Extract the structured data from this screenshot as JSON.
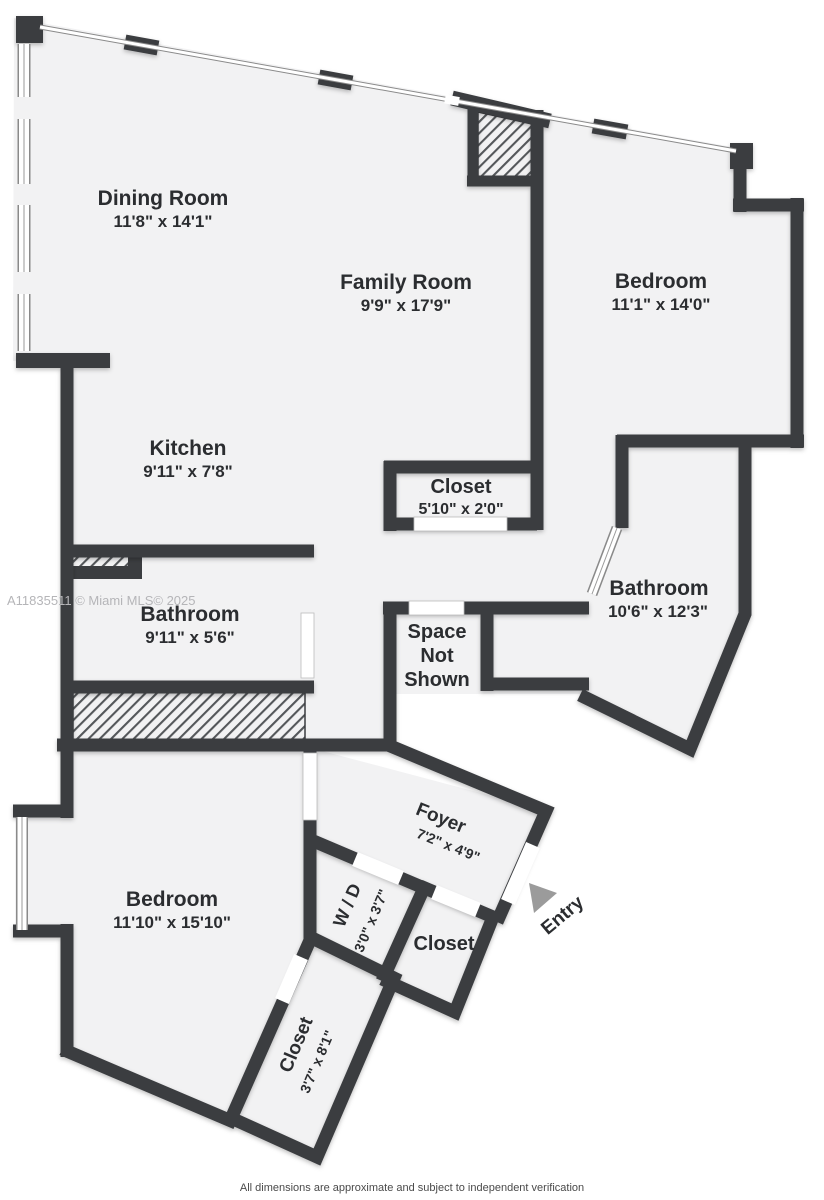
{
  "floorplan": {
    "watermark": "A11835511 © Miami MLS© 2025",
    "disclaimer": "All dimensions are approximate and subject to independent verification",
    "entry_label": "Entry",
    "colors": {
      "wall": "#3b3d40",
      "floor": "#f2f2f3",
      "background": "#ffffff",
      "hatch_line": "#54575a",
      "window_outline": "#8a8a8a",
      "entry_arrow": "#9b9b9b",
      "watermark_text": "#b5b5b8",
      "disclaimer_text": "#4a4a4a"
    },
    "rooms": [
      {
        "id": "dining-room",
        "name": "Dining Room",
        "dims": "11'8\" x 14'1\""
      },
      {
        "id": "family-room",
        "name": "Family Room",
        "dims": "9'9\" x 17'9\""
      },
      {
        "id": "bedroom-1",
        "name": "Bedroom",
        "dims": "11'1\" x 14'0\""
      },
      {
        "id": "kitchen",
        "name": "Kitchen",
        "dims": "9'11\" x 7'8\""
      },
      {
        "id": "closet-hall",
        "name": "Closet",
        "dims": "5'10\" x 2'0\""
      },
      {
        "id": "bathroom-1",
        "name": "Bathroom",
        "dims": "9'11\" x 5'6\""
      },
      {
        "id": "bathroom-2",
        "name": "Bathroom",
        "dims": "10'6\" x 12'3\""
      },
      {
        "id": "space-not-shown",
        "name": "Space Not Shown",
        "line1": "Space",
        "line2": "Not",
        "line3": "Shown"
      },
      {
        "id": "foyer",
        "name": "Foyer",
        "dims": "7'2\" x 4'9\""
      },
      {
        "id": "washer-dryer",
        "name": "W / D",
        "dims": "3'0\" x 3'7\""
      },
      {
        "id": "closet-entry",
        "name": "Closet",
        "dims": ""
      },
      {
        "id": "bedroom-2",
        "name": "Bedroom",
        "dims": "11'10\" x 15'10\""
      },
      {
        "id": "closet-long",
        "name": "Closet",
        "dims": "3'7\" x 8'1\""
      }
    ]
  }
}
